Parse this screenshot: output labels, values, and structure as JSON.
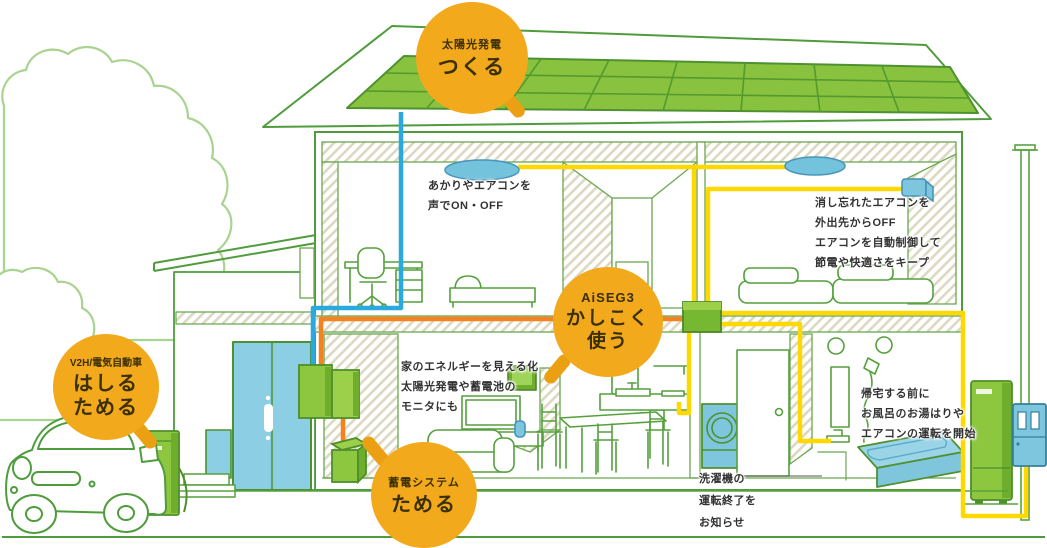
{
  "badges": {
    "solar": {
      "category": "太陽光発電",
      "action": "つくる"
    },
    "aiseg": {
      "category": "AiSEG3",
      "action1": "かしこく",
      "action2": "使う"
    },
    "v2h": {
      "category": "V2H/電気自動車",
      "action1": "はしる",
      "action2": "ためる"
    },
    "battery": {
      "category": "蓄電システム",
      "action": "ためる"
    }
  },
  "annotations": {
    "voice_control": "あかりやエアコンを\n声でON・OFF",
    "aircon_remote": "消し忘れたエアコンを\n外出先からOFF\nエアコンを自動制御して\n節電や快適さをキープ",
    "energy_monitor": "家のエネルギーを見える化\n太陽光発電や蓄電池の\nモニタにも",
    "laundry_notice": "洗濯機の\n運転終了を\nお知らせ",
    "bath_remote": "帰宅する前に\nお風呂のお湯はりや\nエアコンの運転を開始"
  },
  "palette": {
    "badge_orange": "#f2a91c",
    "sketch_green": "#55a03d",
    "equipment_green": "#8dc63f",
    "accent_blue": "#7ec6de",
    "wire_yellow": "#ffd800",
    "wire_orange": "#f5821f",
    "wire_blue": "#2aa9e0",
    "solar_green": "#88c23e"
  }
}
